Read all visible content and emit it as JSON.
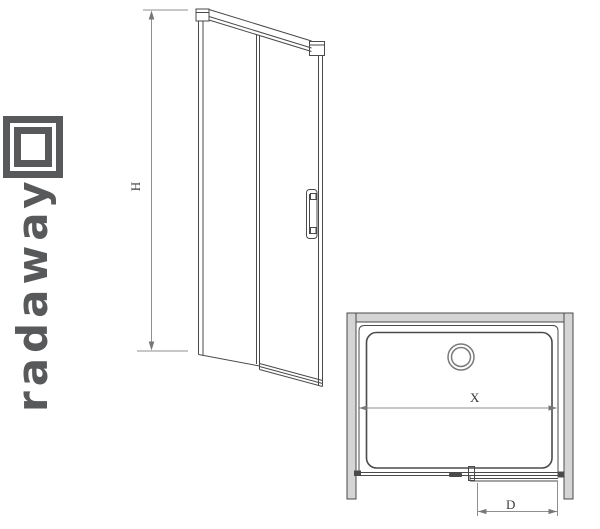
{
  "logo": {
    "brand_text": "radaway",
    "color": "#58595b"
  },
  "front_view": {
    "name": "shower sliding door - front elevation",
    "height_dimension_label": "H"
  },
  "plan_view": {
    "name": "shower enclosure - top plan view",
    "width_dimension_label": "X",
    "door_opening_dimension_label": "D"
  },
  "colors": {
    "line": "#4a4a4a",
    "dimension_line": "#8f8f8f",
    "wall_fill": "#d5d5d5",
    "label_text": "#3a3a3a",
    "background": "#ffffff"
  }
}
